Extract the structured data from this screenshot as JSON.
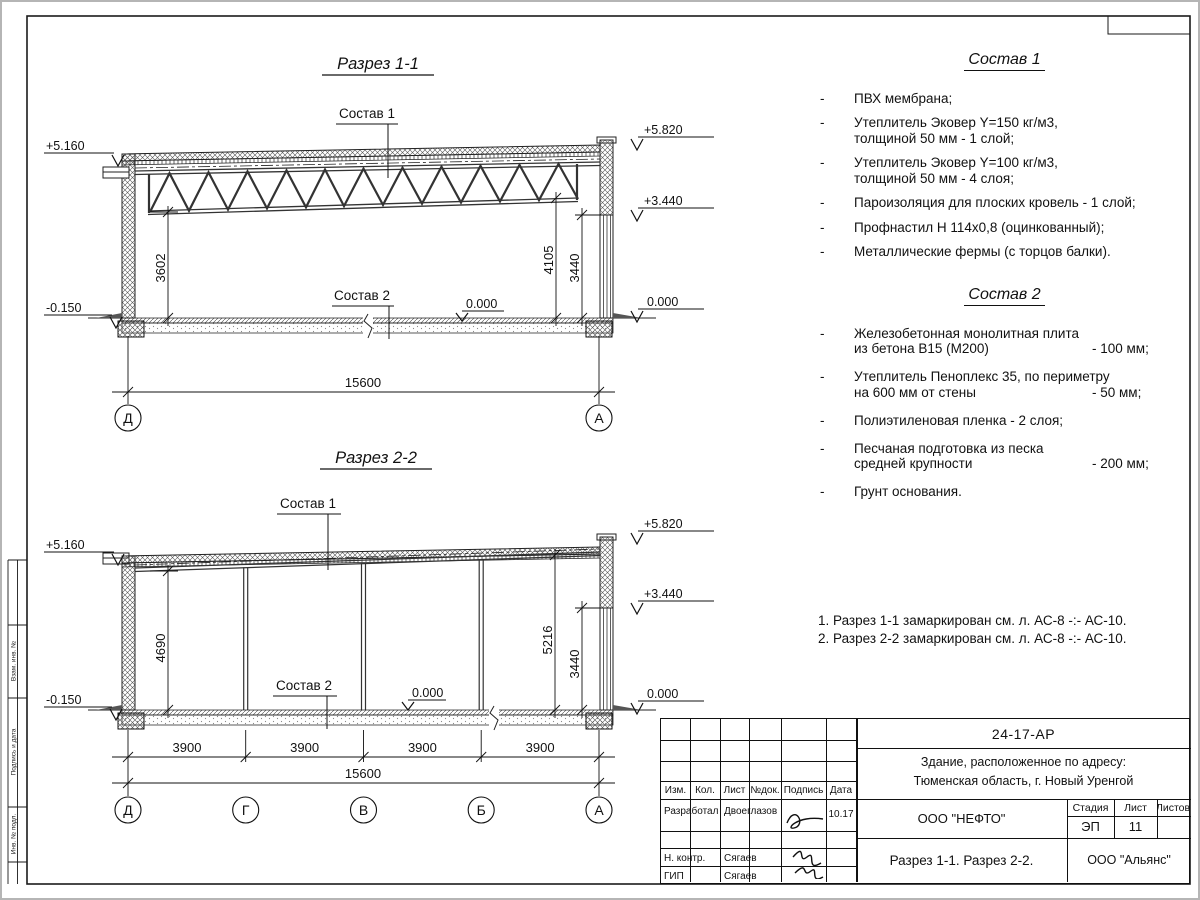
{
  "ui": {
    "dash": "-"
  },
  "section1": {
    "title": "Разрез 1-1",
    "composition1_label": "Состав 1",
    "composition2_label": "Состав 2",
    "zero_label": "0.000",
    "elevations": {
      "left_top": "+5.160",
      "left_bottom": "-0.150",
      "right_top": "+5.820",
      "right_mid": "+3.440",
      "right_zero": "0.000"
    },
    "dims": {
      "left_height": "3602",
      "right_inner": "4105",
      "right_wall": "3440",
      "span": "15600"
    },
    "axes": {
      "left": "Д",
      "right": "А"
    }
  },
  "section2": {
    "title": "Разрез 2-2",
    "composition1_label": "Состав 1",
    "composition2_label": "Состав 2",
    "zero_label": "0.000",
    "elevations": {
      "left_top": "+5.160",
      "left_bottom": "-0.150",
      "right_top": "+5.820",
      "right_mid": "+3.440",
      "right_zero": "0.000"
    },
    "dims": {
      "left_height": "4690",
      "right_inner": "5216",
      "right_wall": "3440",
      "span": "15600",
      "bay": "3900"
    },
    "axes": {
      "a1": "Д",
      "a2": "Г",
      "a3": "В",
      "a4": "Б",
      "a5": "А"
    }
  },
  "composition1": {
    "title": "Состав 1",
    "items": [
      {
        "l1": "ПВХ мембрана;"
      },
      {
        "l1": "Утеплитель Эковер Y=150 кг/м3,",
        "l2": "толщиной 50 мм - 1 слой;"
      },
      {
        "l1": "Утеплитель Эковер Y=100 кг/м3,",
        "l2": "толщиной 50 мм - 4 слоя;"
      },
      {
        "l1": "Пароизоляция для плоских кровель - 1 слой;"
      },
      {
        "l1": "Профнастил Н 114х0,8 (оцинкованный);"
      },
      {
        "l1": "Металлические фермы (с торцов балки)."
      }
    ]
  },
  "composition2": {
    "title": "Состав 2",
    "items": [
      {
        "l1": "Железобетонная  монолитная плита",
        "l2": "из бетона В15 (М200)",
        "v2": "- 100 мм;"
      },
      {
        "l1": "Утеплитель Пеноплекс 35, по периметру",
        "l2": "на 600 мм от стены",
        "v2": "- 50 мм;"
      },
      {
        "l1": "Полиэтиленовая пленка - 2 слоя;"
      },
      {
        "l1": "Песчаная подготовка из песка",
        "l2": "средней крупности",
        "v2": "- 200 мм;"
      },
      {
        "l1": "Грунт основания."
      }
    ]
  },
  "notes": {
    "line1": "1. Разрез 1-1 замаркирован см. л. АС-8 -:- АС-10.",
    "line2": "2. Разрез 2-2 замаркирован см. л. АС-8 -:- АС-10."
  },
  "titleblock": {
    "doc_number": "24-17-АР",
    "object_line1": "Здание, расположенное по адресу:",
    "object_line2": "Тюменская область, г. Новый Уренгой",
    "header": {
      "izm": "Изм.",
      "kol": "Кол.",
      "list": "Лист",
      "ndok": "№док.",
      "podpis": "Подпись",
      "data": "Дата"
    },
    "rows": [
      {
        "role": "Разработал",
        "name": "Двоеглазов",
        "date": "10.17"
      },
      {
        "role": "Н. контр.",
        "name": "Сягаев",
        "date": ""
      },
      {
        "role": "ГИП",
        "name": "Сягаев",
        "date": ""
      }
    ],
    "company": "ООО \"НЕФТО\"",
    "stage_label": "Стадия",
    "sheet_label": "Лист",
    "sheets_label": "Листов",
    "stage": "ЭП",
    "sheet": "11",
    "sheets": "",
    "drawing_title": "Разрез 1-1. Разрез 2-2.",
    "contractor": "ООО \"Альянс\""
  },
  "side_stamp": {
    "label1": "Взам. инв. №",
    "label2": "Подпись и дата",
    "label3": "Инв. № подл."
  }
}
